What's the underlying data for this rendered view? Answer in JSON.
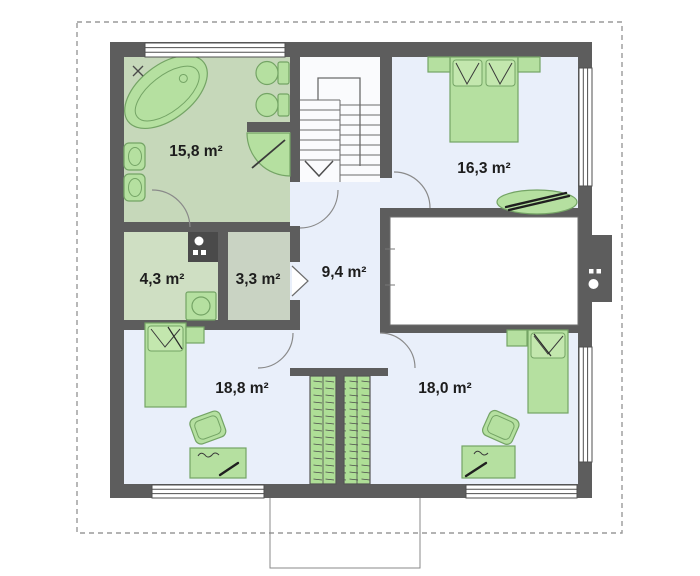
{
  "plan": {
    "rooms": [
      {
        "id": "bathroom",
        "area": "15,8 m²"
      },
      {
        "id": "bedroom-top-right",
        "area": "16,3 m²"
      },
      {
        "id": "utility-room",
        "area": "4,3 m²"
      },
      {
        "id": "closet",
        "area": "3,3 m²"
      },
      {
        "id": "hall-landing",
        "area": "9,4 m²"
      },
      {
        "id": "bedroom-bottom-left",
        "area": "18,8 m²"
      },
      {
        "id": "bedroom-bottom-right",
        "area": "18,0 m²"
      }
    ],
    "colors": {
      "wall": "#5d5d5d",
      "bathroom_floor": "#c6d8ba",
      "utility_floor": "#cfdfc3",
      "closet_floor": "#c9d3c3",
      "bedroom_floor": "#e9effa",
      "furniture": "#b5e0a0",
      "furniture_stroke": "#74a465",
      "plot_boundary_dash": "#9a9a9a",
      "label_text": "#1d1d1d"
    }
  }
}
